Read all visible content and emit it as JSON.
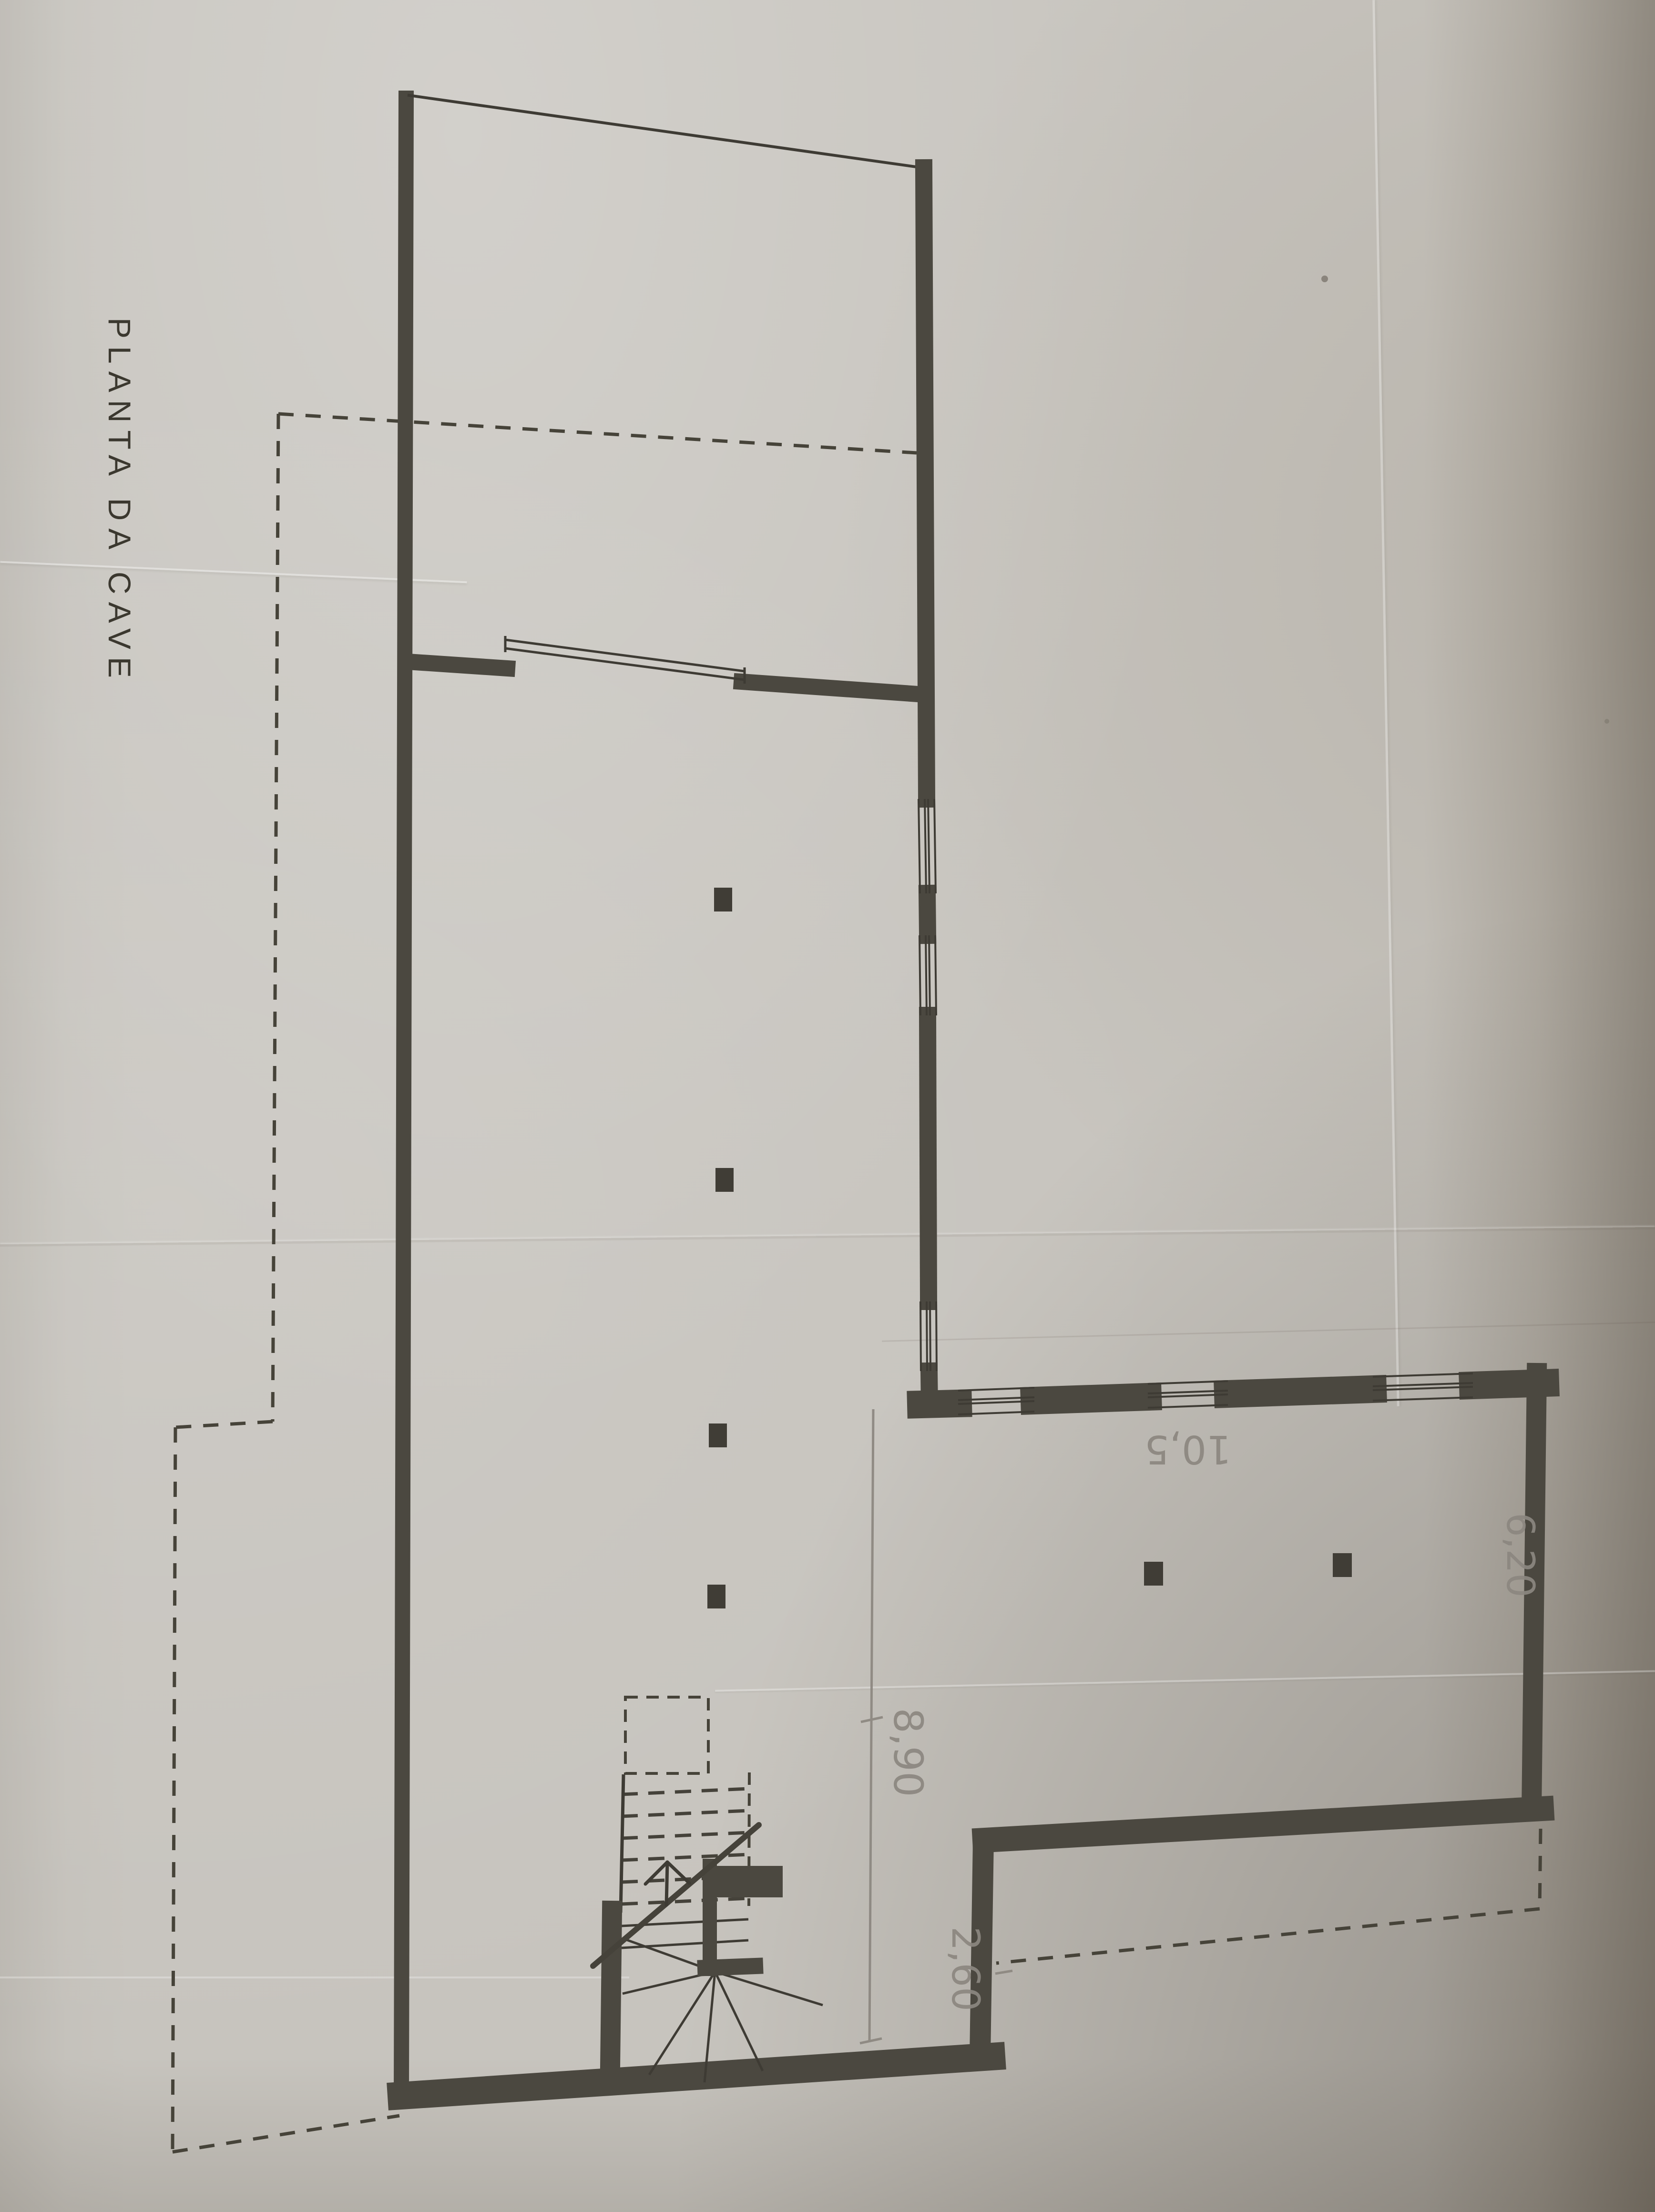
{
  "document": {
    "kind": "scanned basement floor-plan drawing, rotated 90 degrees on page",
    "title": "PLANTA DA CAVE"
  },
  "title": {
    "text": "PLANTA DA CAVE"
  },
  "labels": {
    "dim_10_5": "10,5",
    "dim_6_20": "6,20",
    "dim_8_90": "8,90",
    "dim_2_60": "2,60"
  },
  "dimensions_meters": [
    {
      "text": "10,5",
      "location": "wing interior near top wall",
      "rotation_deg": 180
    },
    {
      "text": "6,20",
      "location": "wing interior near right wall",
      "rotation_deg": 90
    },
    {
      "text": "8,90",
      "location": "along vertical pencil dimension line",
      "rotation_deg": 90
    },
    {
      "text": "2,60",
      "location": "beside step wall near stairs",
      "rotation_deg": 90
    }
  ],
  "plan_features": {
    "outline": "L-shaped basement with thick masonry walls",
    "window_openings": {
      "upper_right_wall": 3,
      "wing_top_wall": 3
    },
    "interior_partition_with_wide_opening": true,
    "columns": 6,
    "staircase": {
      "type": "quarter-turn winder stair",
      "dashed_flight_above_break_line": true,
      "break_line_slash": true,
      "direction_arrow": true
    },
    "dashed_boundary_lines": "projection/property limits at left, bottom-left and lower-right"
  },
  "colors": {
    "paper": "#c7c4be",
    "wall_ink": "#4b4840",
    "thin_ink": "#3e3b34",
    "dashed_ink": "#464339",
    "pencil": "#8c8780",
    "page_shadow": "#6f6250"
  }
}
